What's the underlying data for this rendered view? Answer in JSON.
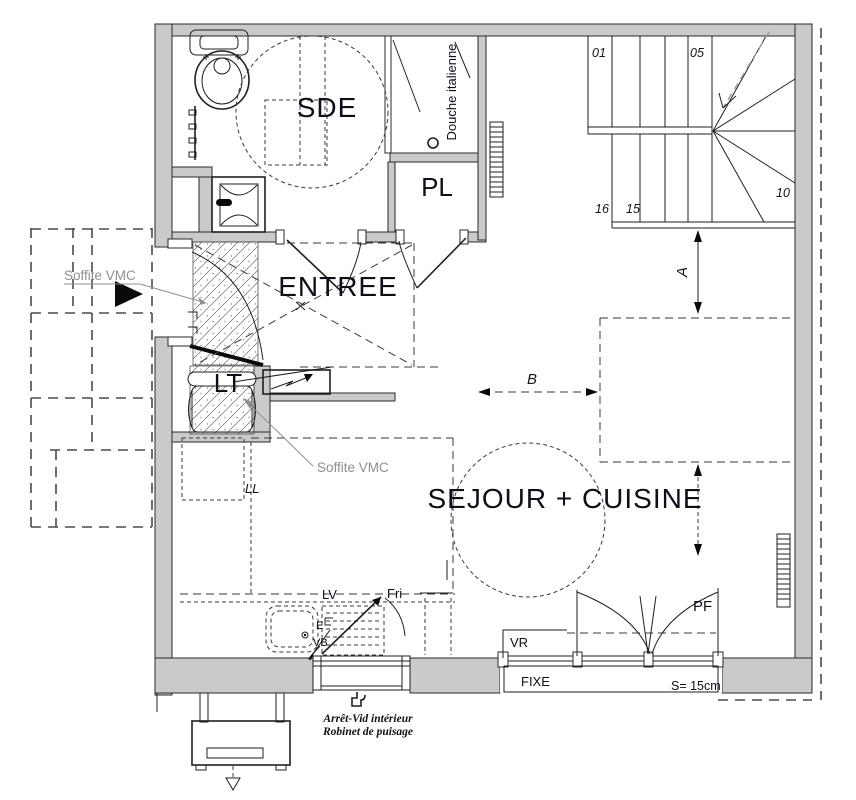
{
  "rooms": {
    "sde": "SDE",
    "pl": "PL",
    "entree": "ENTREE",
    "lt": "LT",
    "sejour_cuisine": "SEJOUR + CUISINE"
  },
  "annotations": {
    "douche_italienne": "Douche italienne",
    "soffite_vmc_left": "Soffite VMC",
    "soffite_vmc_kitchen": "Soffite VMC",
    "ll": "LL",
    "lv": "LV",
    "fri": "Fri",
    "e": "E",
    "vb": "VB",
    "vr": "VR",
    "fixe": "FIXE",
    "pf": "PF",
    "seuil": "S= 15cm",
    "arret_vid": "Arrêt-Vid intérieur",
    "robinet": "Robinet de puisage"
  },
  "dimensions": {
    "a": "A",
    "b": "B"
  },
  "stairs": {
    "n01": "01",
    "n05": "05",
    "n10": "10",
    "n15": "15",
    "n16": "16"
  },
  "colors": {
    "wall_fill": "#cacaca",
    "line": "#1f1f1f",
    "label": "#0e0e1a",
    "muted_label": "#8f8f8f"
  }
}
